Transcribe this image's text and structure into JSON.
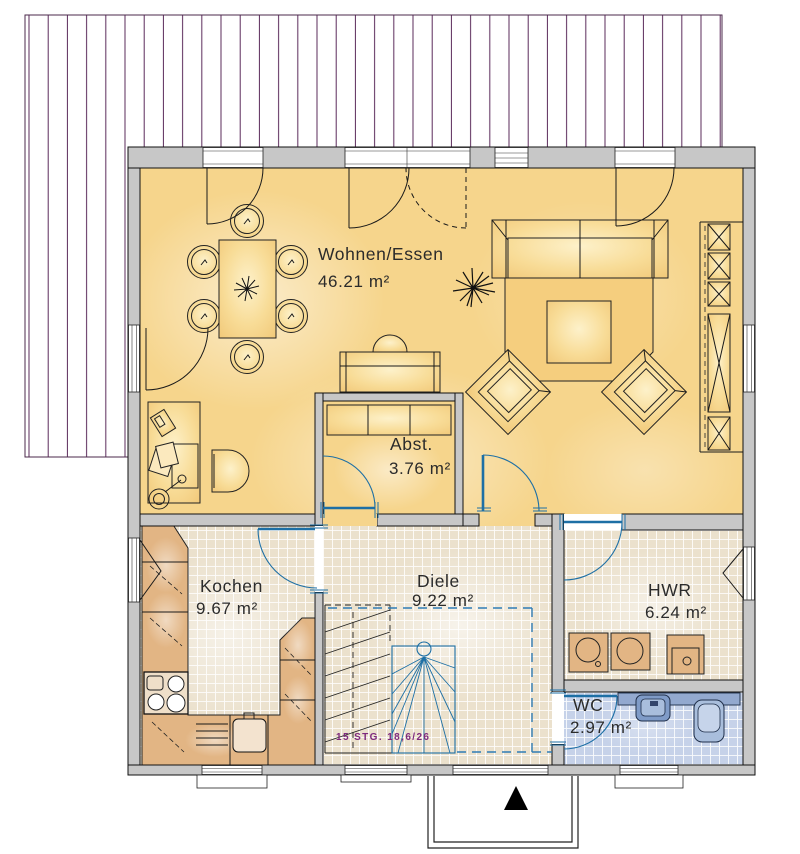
{
  "plan": {
    "rooms": [
      {
        "name": "Wohnen/Essen",
        "area": "46.21 m²"
      },
      {
        "name": "Abst.",
        "area": "3.76 m²"
      },
      {
        "name": "Kochen",
        "area": "9.67 m²"
      },
      {
        "name": "Diele",
        "area": "9.22 m²"
      },
      {
        "name": "HWR",
        "area": "6.24 m²"
      },
      {
        "name": "WC",
        "area": "2.97 m²"
      }
    ],
    "stair_note": "15 STG. 18,6/26",
    "colors": {
      "wall_fill": "#c7c7c7",
      "living_floor": "#f6d58c",
      "tile_floor": "#ebe1cd",
      "wc_tile_floor": "#c6d2e9",
      "counter_tan": "#e2b584",
      "door_blue": "#1d6fa5",
      "deck_stripe": "#5a2a5a",
      "stair_text": "#7e2a7e"
    }
  }
}
